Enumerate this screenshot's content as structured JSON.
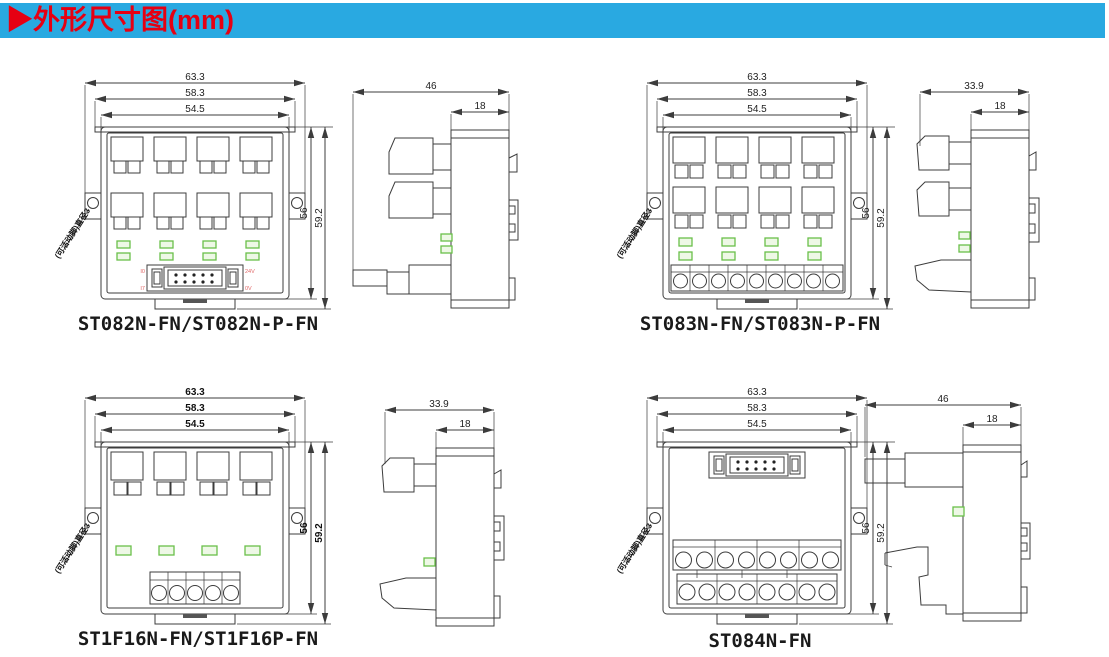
{
  "header": {
    "title": "▶外形尺寸图(mm)"
  },
  "colors": {
    "header_bg": "#29a9e1",
    "header_text": "#e60012",
    "line": "#3c3c3c",
    "led_green": "#6abf4a",
    "pin_red": "#e06666"
  },
  "drawings": [
    {
      "caption": "ST082N-FN/ST082N-P-FN",
      "front": {
        "w1": "63.3",
        "w2": "58.3",
        "w3": "54.5",
        "h1": "56",
        "h2": "59.2",
        "note": "(可活动脚)直径3",
        "pins": {
          "tl": "I0",
          "bl": "I7",
          "tr": "24V",
          "br": "0V"
        }
      },
      "side": {
        "w": "46",
        "b": "18"
      }
    },
    {
      "caption": "ST083N-FN/ST083N-P-FN",
      "front": {
        "w1": "63.3",
        "w2": "58.3",
        "w3": "54.5",
        "h1": "56",
        "h2": "59.2",
        "note": "(可活动脚)直径3"
      },
      "side": {
        "w": "33.9",
        "b": "18"
      }
    },
    {
      "caption": "ST1F16N-FN/ST1F16P-FN",
      "front": {
        "w1": "63.3",
        "w2": "58.3",
        "w3": "54.5",
        "h1": "56",
        "h2": "59.2",
        "note": "(可活动脚)直径3"
      },
      "side": {
        "w": "33.9",
        "b": "18"
      }
    },
    {
      "caption": "ST084N-FN",
      "front": {
        "w1": "63.3",
        "w2": "58.3",
        "w3": "54.5",
        "h1": "56",
        "h2": "59.2",
        "note": "(可活动脚)直径3"
      },
      "side": {
        "w": "46",
        "b": "18"
      }
    }
  ]
}
